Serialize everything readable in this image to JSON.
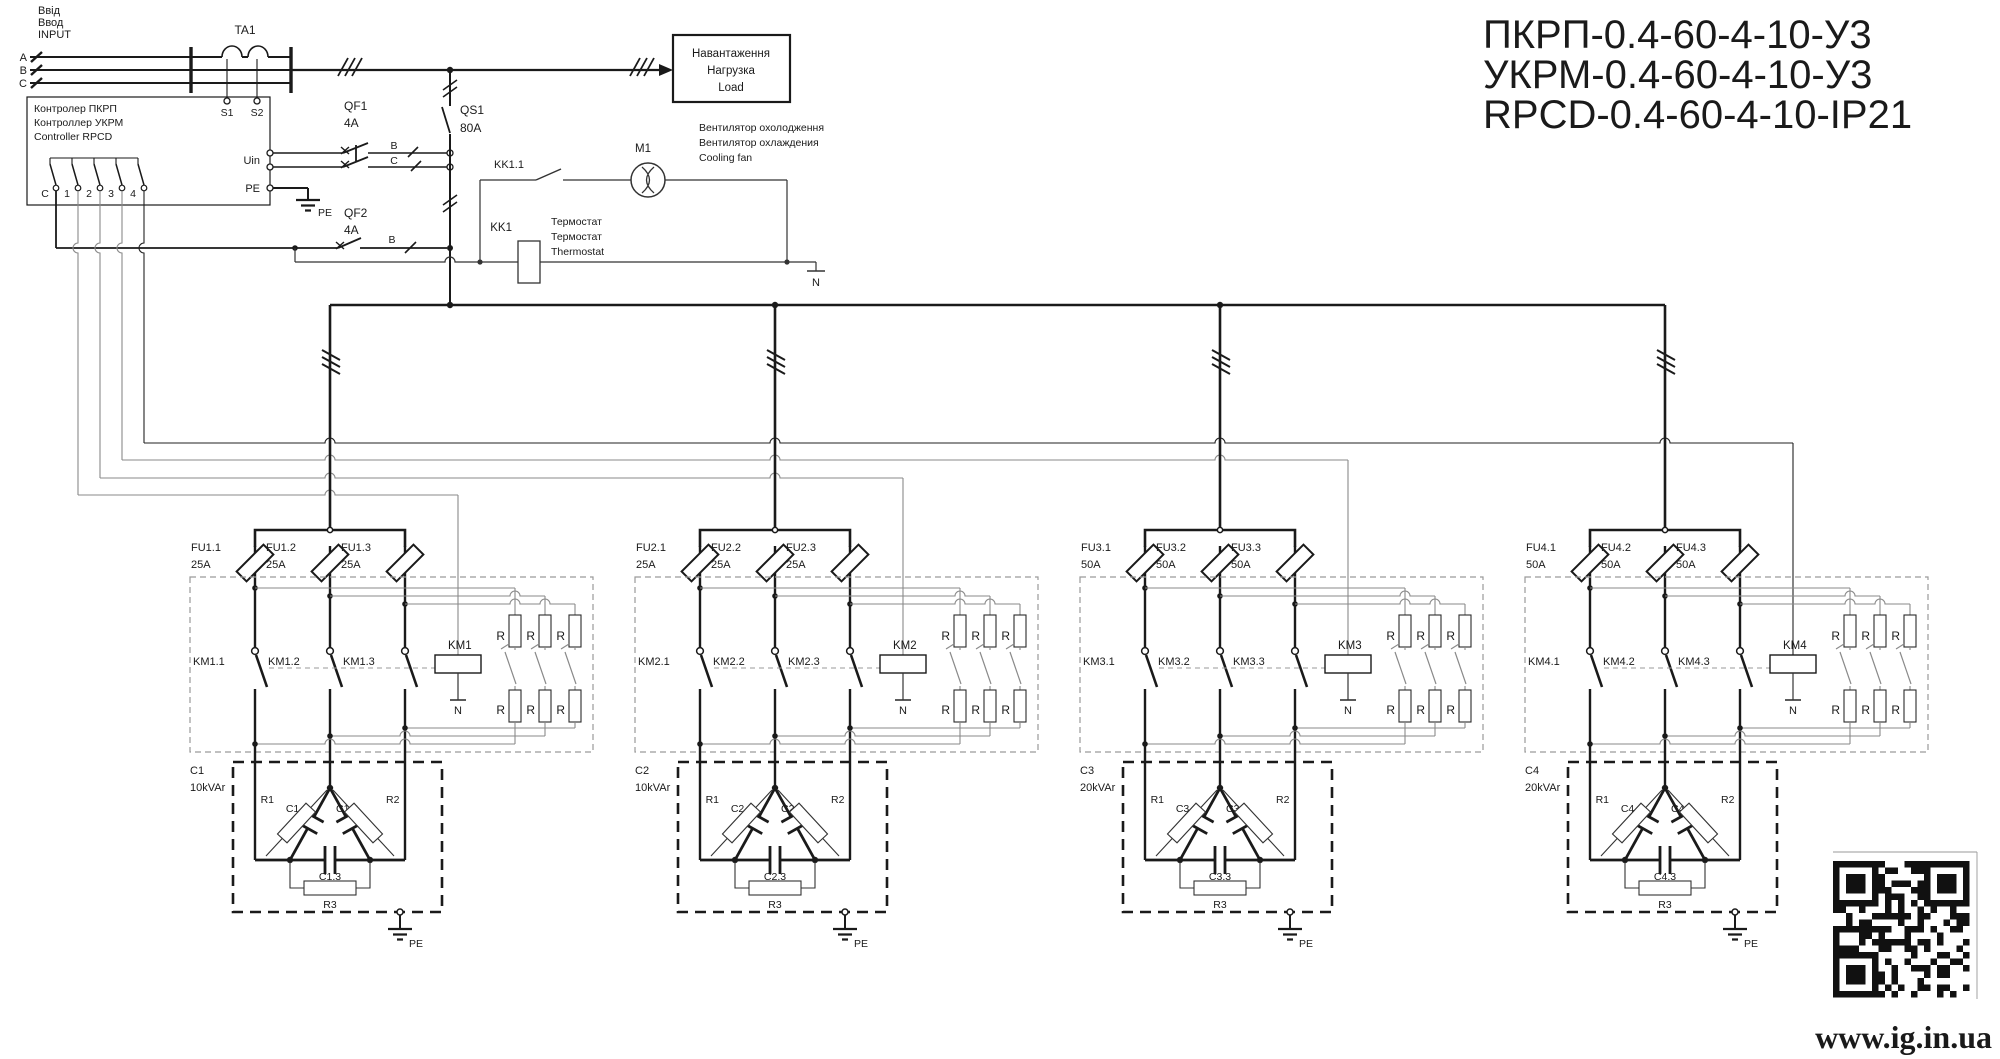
{
  "title": {
    "line1": "ПКРП-0.4-60-4-10-У3",
    "line2": "УКРМ-0.4-60-4-10-У3",
    "line3": "RPCD-0.4-60-4-10-IP21"
  },
  "input": {
    "label_uk": "Ввід",
    "label_ru": "Ввод",
    "label_en": "INPUT",
    "phase_a": "A",
    "phase_b": "B",
    "phase_c": "C"
  },
  "ct": {
    "label": "TA1",
    "s1": "S1",
    "s2": "S2"
  },
  "controller": {
    "name_uk": "Контролер ПКРП",
    "name_ru": "Контроллер УКРМ",
    "name_en": "Controller RPCD",
    "out_c": "C",
    "out_1": "1",
    "out_2": "2",
    "out_3": "3",
    "out_4": "4",
    "uin": "Uin",
    "pe": "PE"
  },
  "qf1": {
    "label": "QF1",
    "rating": "4A",
    "phase_b": "B",
    "phase_c": "C"
  },
  "qs1": {
    "label": "QS1",
    "rating": "80A"
  },
  "qf2": {
    "label": "QF2",
    "rating": "4A",
    "phase_b": "B"
  },
  "pe_ground": "PE",
  "load": {
    "uk": "Навантаження",
    "ru": "Нагрузка",
    "en": "Load"
  },
  "fan": {
    "motor": "M1",
    "contact": "KK1.1",
    "uk": "Вентилятор охолодження",
    "ru": "Вентилятор охлаждения",
    "en": "Cooling fan"
  },
  "thermostat": {
    "label": "KK1",
    "uk": "Термостат",
    "ru": "Термостат",
    "en": "Thermostat",
    "neutral": "N"
  },
  "resistor": "R",
  "branches": [
    {
      "fuses": [
        {
          "label": "FU1.1",
          "rating": "25A"
        },
        {
          "label": "FU1.2",
          "rating": "25A"
        },
        {
          "label": "FU1.3",
          "rating": "25A"
        }
      ],
      "contacts": [
        "KM1.1",
        "KM1.2",
        "KM1.3"
      ],
      "coil": "KM1",
      "neutral": "N",
      "bank": {
        "label": "C1",
        "power": "10kVAr",
        "caps": [
          "C1.1",
          "C1.2",
          "C1.3"
        ],
        "resistors": [
          "R1",
          "R2",
          "R3"
        ],
        "pe": "PE"
      }
    },
    {
      "fuses": [
        {
          "label": "FU2.1",
          "rating": "25A"
        },
        {
          "label": "FU2.2",
          "rating": "25A"
        },
        {
          "label": "FU2.3",
          "rating": "25A"
        }
      ],
      "contacts": [
        "KM2.1",
        "KM2.2",
        "KM2.3"
      ],
      "coil": "KM2",
      "neutral": "N",
      "bank": {
        "label": "C2",
        "power": "10kVAr",
        "caps": [
          "C2.1",
          "C2.2",
          "C2.3"
        ],
        "resistors": [
          "R1",
          "R2",
          "R3"
        ],
        "pe": "PE"
      }
    },
    {
      "fuses": [
        {
          "label": "FU3.1",
          "rating": "50A"
        },
        {
          "label": "FU3.2",
          "rating": "50A"
        },
        {
          "label": "FU3.3",
          "rating": "50A"
        }
      ],
      "contacts": [
        "KM3.1",
        "KM3.2",
        "KM3.3"
      ],
      "coil": "KM3",
      "neutral": "N",
      "bank": {
        "label": "C3",
        "power": "20kVAr",
        "caps": [
          "C3.1",
          "C3.2",
          "C3.3"
        ],
        "resistors": [
          "R1",
          "R2",
          "R3"
        ],
        "pe": "PE"
      }
    },
    {
      "fuses": [
        {
          "label": "FU4.1",
          "rating": "50A"
        },
        {
          "label": "FU4.2",
          "rating": "50A"
        },
        {
          "label": "FU4.3",
          "rating": "50A"
        }
      ],
      "contacts": [
        "KM4.1",
        "KM4.2",
        "KM4.3"
      ],
      "coil": "KM4",
      "neutral": "N",
      "bank": {
        "label": "C4",
        "power": "20kVAr",
        "caps": [
          "C4.1",
          "C4.2",
          "C4.3"
        ],
        "resistors": [
          "R1",
          "R2",
          "R3"
        ],
        "pe": "PE"
      }
    }
  ],
  "website": "www.ig.in.ua",
  "colors": {
    "ink": "#1a1a1a",
    "wire_gray": "#8a8a8a",
    "dash_gray": "#9a9a9a"
  }
}
